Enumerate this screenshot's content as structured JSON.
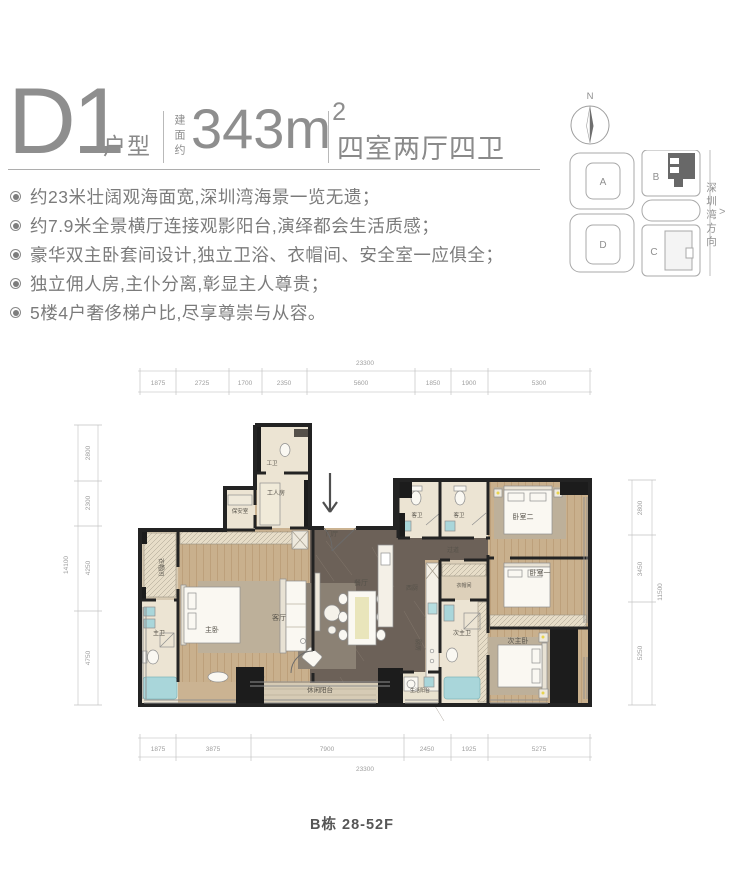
{
  "header": {
    "unit_code": "D1",
    "unit_label": "户型",
    "area_prefix": "建面约",
    "area_value": "343m",
    "area_sup": "2",
    "layout": "四室两厅四卫"
  },
  "features": [
    "约23米壮阔观海面宽,深圳湾海景一览无遗；",
    "约7.9米全景横厅连接观影阳台,演绎都会生活质感；",
    "豪华双主卧套间设计,独立卫浴、衣帽间、安全室一应俱全；",
    "独立佣人房,主仆分离,彰显主人尊贵；",
    "5楼4户奢侈梯户比,尽享尊崇与从容。"
  ],
  "compass": {
    "north_label": "N"
  },
  "siteplan": {
    "blocks": [
      "A",
      "B",
      "D",
      "C"
    ],
    "direction_label": "深圳湾方向",
    "direction_arrow": ">"
  },
  "plan": {
    "rooms": [
      "工卫",
      "工人房",
      "保安室",
      "门厅",
      "衣帽间",
      "主卫",
      "主卧",
      "客厅",
      "餐厅",
      "休闲阳台",
      "西厨",
      "过道",
      "厨房",
      "生活阳台",
      "次主卫",
      "次主卧",
      "衣帽间",
      "卧室二",
      "卧室一",
      "客卫",
      "客卫"
    ],
    "dims": {
      "top": {
        "total": "23300",
        "segments": [
          "1875",
          "2725",
          "1700",
          "2350",
          "5600",
          "1850",
          "1900",
          "5300"
        ]
      },
      "bottom": {
        "total": "23300",
        "segments": [
          "1875",
          "3875",
          "7900",
          "2450",
          "1925",
          "5275"
        ]
      },
      "left": {
        "total": "14100",
        "segments": [
          "2800",
          "2300",
          "4250",
          "4750"
        ]
      },
      "right": {
        "total": "11500",
        "segments": [
          "2800",
          "3450",
          "5250"
        ]
      }
    }
  },
  "footer": {
    "building_label": "B栋 28-52F"
  },
  "colors": {
    "wall": "#232323",
    "wood_floor": "#c9b08d",
    "stone_floor": "#6c6158",
    "bath_floor": "#ece4d3",
    "tub_blue": "#a9d6da",
    "text_gray": "#8a8a8a"
  }
}
